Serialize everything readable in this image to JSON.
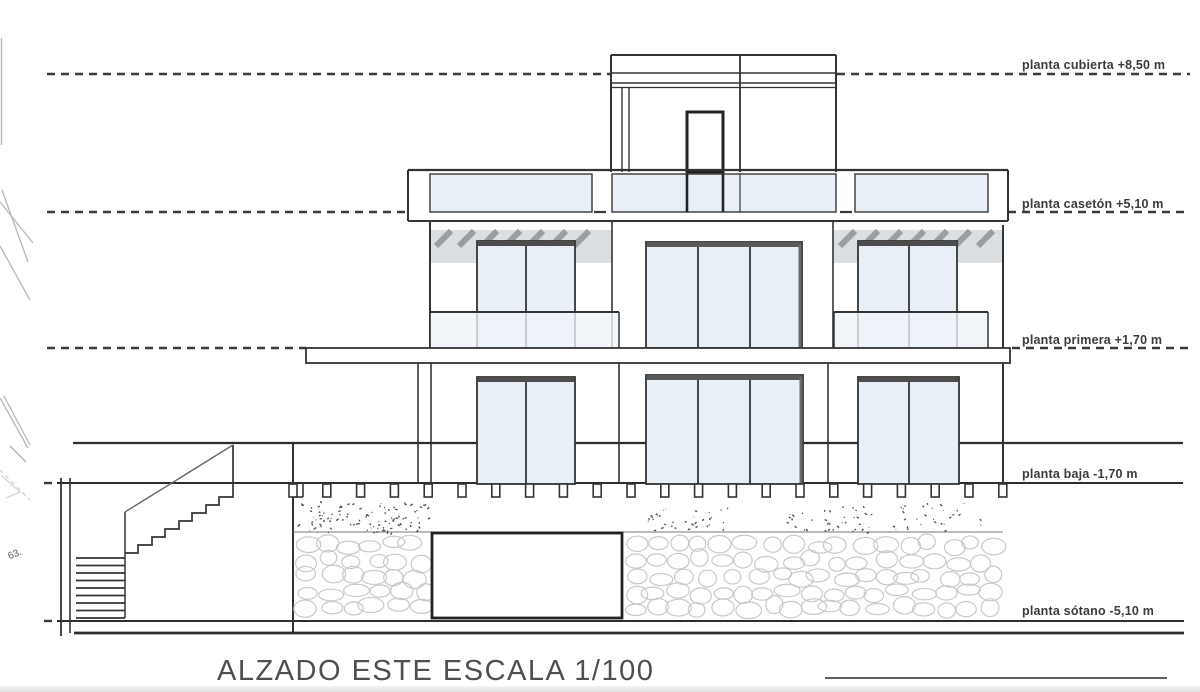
{
  "document": {
    "title": "ALZADO ESTE ESCALA 1/100",
    "margin_note": "63."
  },
  "levels": [
    {
      "name": "planta cubierta",
      "elevation": "+8,50 m",
      "label": "planta cubierta +8,50 m"
    },
    {
      "name": "planta casetón",
      "elevation": "+5,10 m",
      "label": "planta casetón +5,10 m"
    },
    {
      "name": "planta primera",
      "elevation": "+1,70 m",
      "label": "planta primera +1,70 m"
    },
    {
      "name": "planta baja",
      "elevation": "-1,70 m",
      "label": "planta baja -1,70 m"
    },
    {
      "name": "planta sótano",
      "elevation": "-5,10 m",
      "label": "planta sótano -5,10 m"
    }
  ],
  "colors": {
    "line": "#333333",
    "dark": "#222222",
    "glass": "#e9eff7",
    "railing_glass": "#eef4fa",
    "shade_band": "#dcdfe2",
    "hatch_mark": "#989ea4",
    "stone_outline": "#c9c9c9",
    "vegetation": "#4b4b4b",
    "paper": "#ffffff"
  }
}
